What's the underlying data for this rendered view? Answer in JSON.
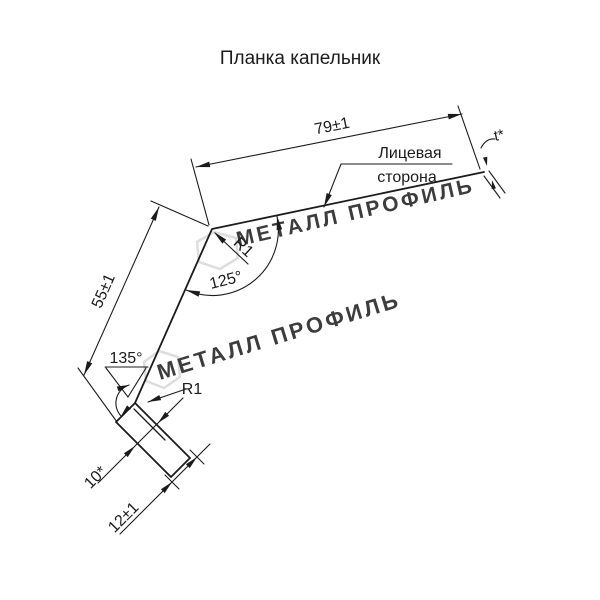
{
  "title": "Планка капельник",
  "labels": {
    "dim_top_flange": "79±1",
    "dim_side": "55±1",
    "dim_hook_kick": "10*",
    "dim_hook_end": "12±1",
    "angle_top": "125°",
    "angle_bottom": "135°",
    "radius_top": "R1",
    "radius_bottom": "R1",
    "thickness": "t*",
    "face_side_line1": "Лицевая",
    "face_side_line2": "сторона"
  },
  "watermark": {
    "text": "МЕТАЛЛ ПРОФИЛЬ",
    "color": "#d0d0d0"
  },
  "colors": {
    "background": "#ffffff",
    "line": "#1b1b1b",
    "text": "#1b1b1b"
  }
}
